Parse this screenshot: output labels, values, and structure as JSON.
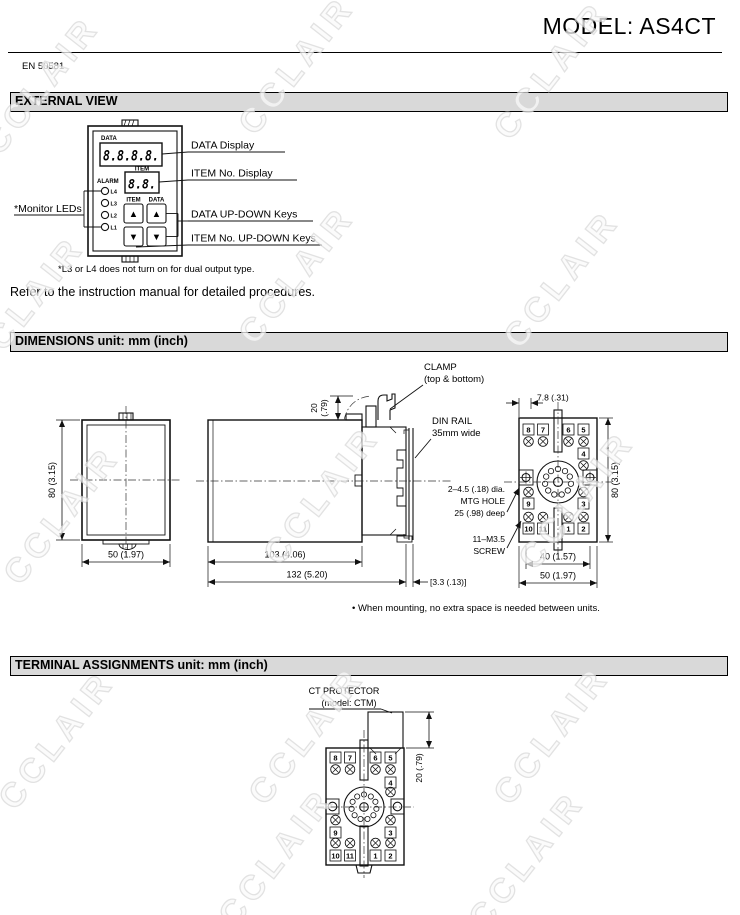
{
  "page": {
    "title": "MODEL: AS4CT",
    "standard": "EN 50581",
    "watermark": "CCLAIR"
  },
  "sections": {
    "external_view": "EXTERNAL VIEW",
    "dimensions": "DIMENSIONS unit: mm (inch)",
    "terminal_assignments": "TERMINAL ASSIGNMENTS unit: mm (inch)"
  },
  "external_view": {
    "panel": {
      "data_label": "DATA",
      "data_display": "8.8.8.8.",
      "item_label": "ITEM",
      "item_display": "8.8.",
      "alarm_label": "ALARM",
      "led_labels": [
        "L4",
        "L3",
        "L2",
        "L1"
      ],
      "item_key_label": "ITEM",
      "data_key_label": "DATA",
      "up_glyph": "▲",
      "down_glyph": "▼"
    },
    "callouts": {
      "monitor_leds": "*Monitor LEDs",
      "data_display": "DATA Display",
      "item_display": "ITEM No. Display",
      "data_keys": "DATA UP-DOWN Keys",
      "item_keys": "ITEM No. UP-DOWN Keys"
    },
    "footnote": "*L3 or L4 does not turn on for dual output type.",
    "refer_note": "Refer to the instruction manual for detailed procedures."
  },
  "dimensions": {
    "front_view": {
      "height": "80 (3.15)",
      "width": "50 (1.97)"
    },
    "side_view": {
      "clamp_line1": "CLAMP",
      "clamp_line2": "(top & bottom)",
      "clamp_height_mm": "20",
      "clamp_height_in": "(.79)",
      "din_rail_line1": "DIN RAIL",
      "din_rail_line2": "35mm wide",
      "body_depth": "103 (4.06)",
      "total_depth": "132 (5.20)",
      "rail_gap": "[3.3 (.13)]"
    },
    "socket_view": {
      "hole_offset": "7.8 (.31)",
      "height": "80 (3.15)",
      "hole_pitch": "40 (1.57)",
      "width": "50 (1.97)",
      "mtg_line1": "2–4.5 (.18) dia.",
      "mtg_line2": "MTG HOLE",
      "mtg_line3": "25 (.98) deep",
      "screw_line1": "11–M3.5",
      "screw_line2": "SCREW"
    },
    "mounting_note": "• When mounting, no extra space is needed between units."
  },
  "socket": {
    "terminals_top": [
      "8",
      "7",
      "6",
      "5"
    ],
    "terminal_right": "4",
    "terminal_left": "9",
    "terminal_right_lower": "3",
    "terminals_bottom": [
      "10",
      "11",
      "1",
      "2"
    ]
  },
  "terminal_assignments": {
    "protector_line1": "CT PROTECTOR",
    "protector_line2": "(model: CTM)",
    "protector_height": "20 (.79)"
  }
}
